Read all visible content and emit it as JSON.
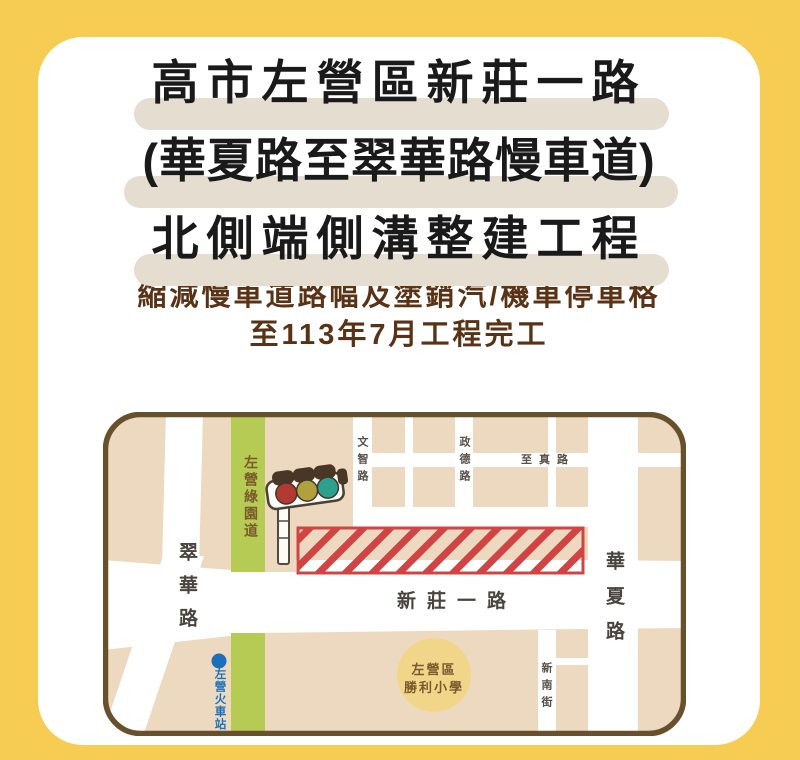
{
  "poster": {
    "title": {
      "lines": [
        "高市左營區新莊一路",
        "(華夏路至翠華路慢車道)",
        "北側端側溝整建工程"
      ]
    },
    "subtitle": {
      "lines": [
        "縮減慢車道路幅及塗銷汽/機車停車格",
        "至113年7月工程完工"
      ]
    }
  },
  "map": {
    "labels": {
      "cuihua_road": "翠華路",
      "zuoying_greenway": "左營綠園道",
      "xinzhuang_1st_road": "新莊一路",
      "huaxia_road": "華夏路",
      "wenzhi_road": "文智路",
      "zhengde_road": "政德路",
      "zhizhen_road": "至真路",
      "xinnan_street": "新南街",
      "school_line1": "左營區",
      "school_line2": "勝利小學",
      "zuoying_station": "左營火車站"
    },
    "icons": {
      "construction_zone": "red-hatched-rectangle",
      "traffic_light": "traffic-light-icon",
      "station_marker": "blue-dot"
    }
  },
  "colors": {
    "background": "#f6cc52",
    "card": "#ffffff",
    "title_highlight": "#e5ddd0",
    "title_text": "#1a1a1a",
    "subtitle_text": "#5a3317",
    "map_background": "#edd9bf",
    "map_border": "#69502d",
    "road": "#ffffff",
    "greenway": "#b6cb53",
    "construction_red": "#d04444",
    "school_circle": "#f1d68a",
    "station_blue": "#1c70bb",
    "traffic_red": "#b23a33",
    "traffic_yellow": "#b0a03e",
    "traffic_teal": "#2ea18e"
  }
}
